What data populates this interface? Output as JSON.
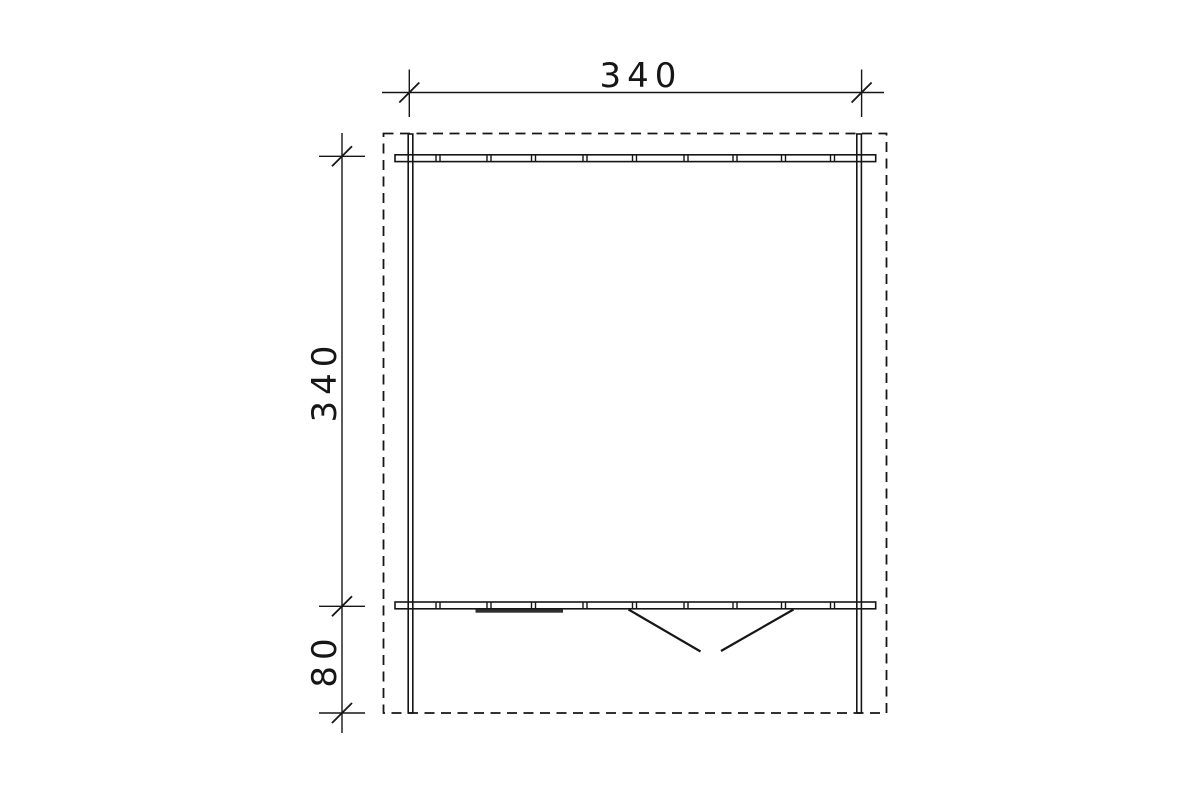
{
  "drawing": {
    "background_color": "#ffffff",
    "line_color": "#161616",
    "window_fill_color": "#2e2e2e",
    "dimensions": {
      "top_width_label": "340",
      "left_depth_label": "340",
      "left_porch_label": "80"
    },
    "features": {
      "roof_outline": "dashed-rectangle",
      "walls": "double-line",
      "window": "filled-bar-marker",
      "door": "double-leaf-outward-swing"
    }
  }
}
